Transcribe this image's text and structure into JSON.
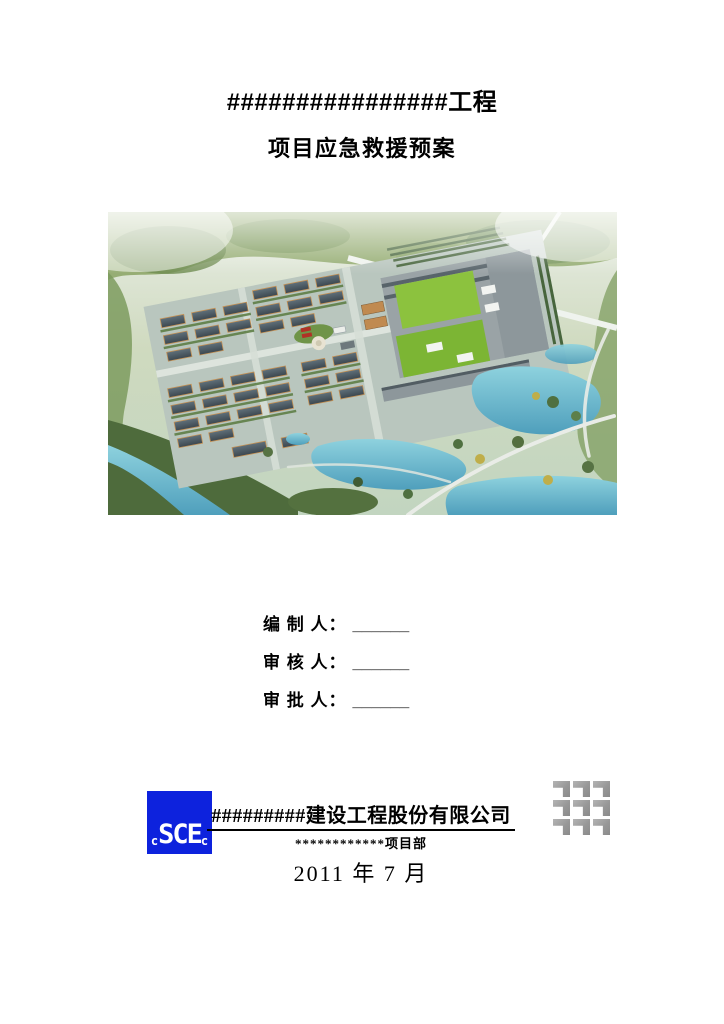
{
  "cover": {
    "title_line1": "################工程",
    "title_line2": "项目应急救援预案"
  },
  "signatures": [
    {
      "label": "编 制 人：",
      "blank": "______"
    },
    {
      "label": "审 核 人：",
      "blank": "______"
    },
    {
      "label": "审 批 人：",
      "blank": "______"
    }
  ],
  "footer": {
    "logo_letters": [
      "c",
      "S",
      "C",
      "E",
      "c"
    ],
    "company": "#########建设工程股份有限公司",
    "department": "************项目部",
    "date": "2011 年 7 月"
  },
  "colors": {
    "logo_blue": "#0d22dd",
    "grid_gray": "#9a9a9a",
    "water": "#63b2c9",
    "lawn_green": "#86c03a"
  }
}
